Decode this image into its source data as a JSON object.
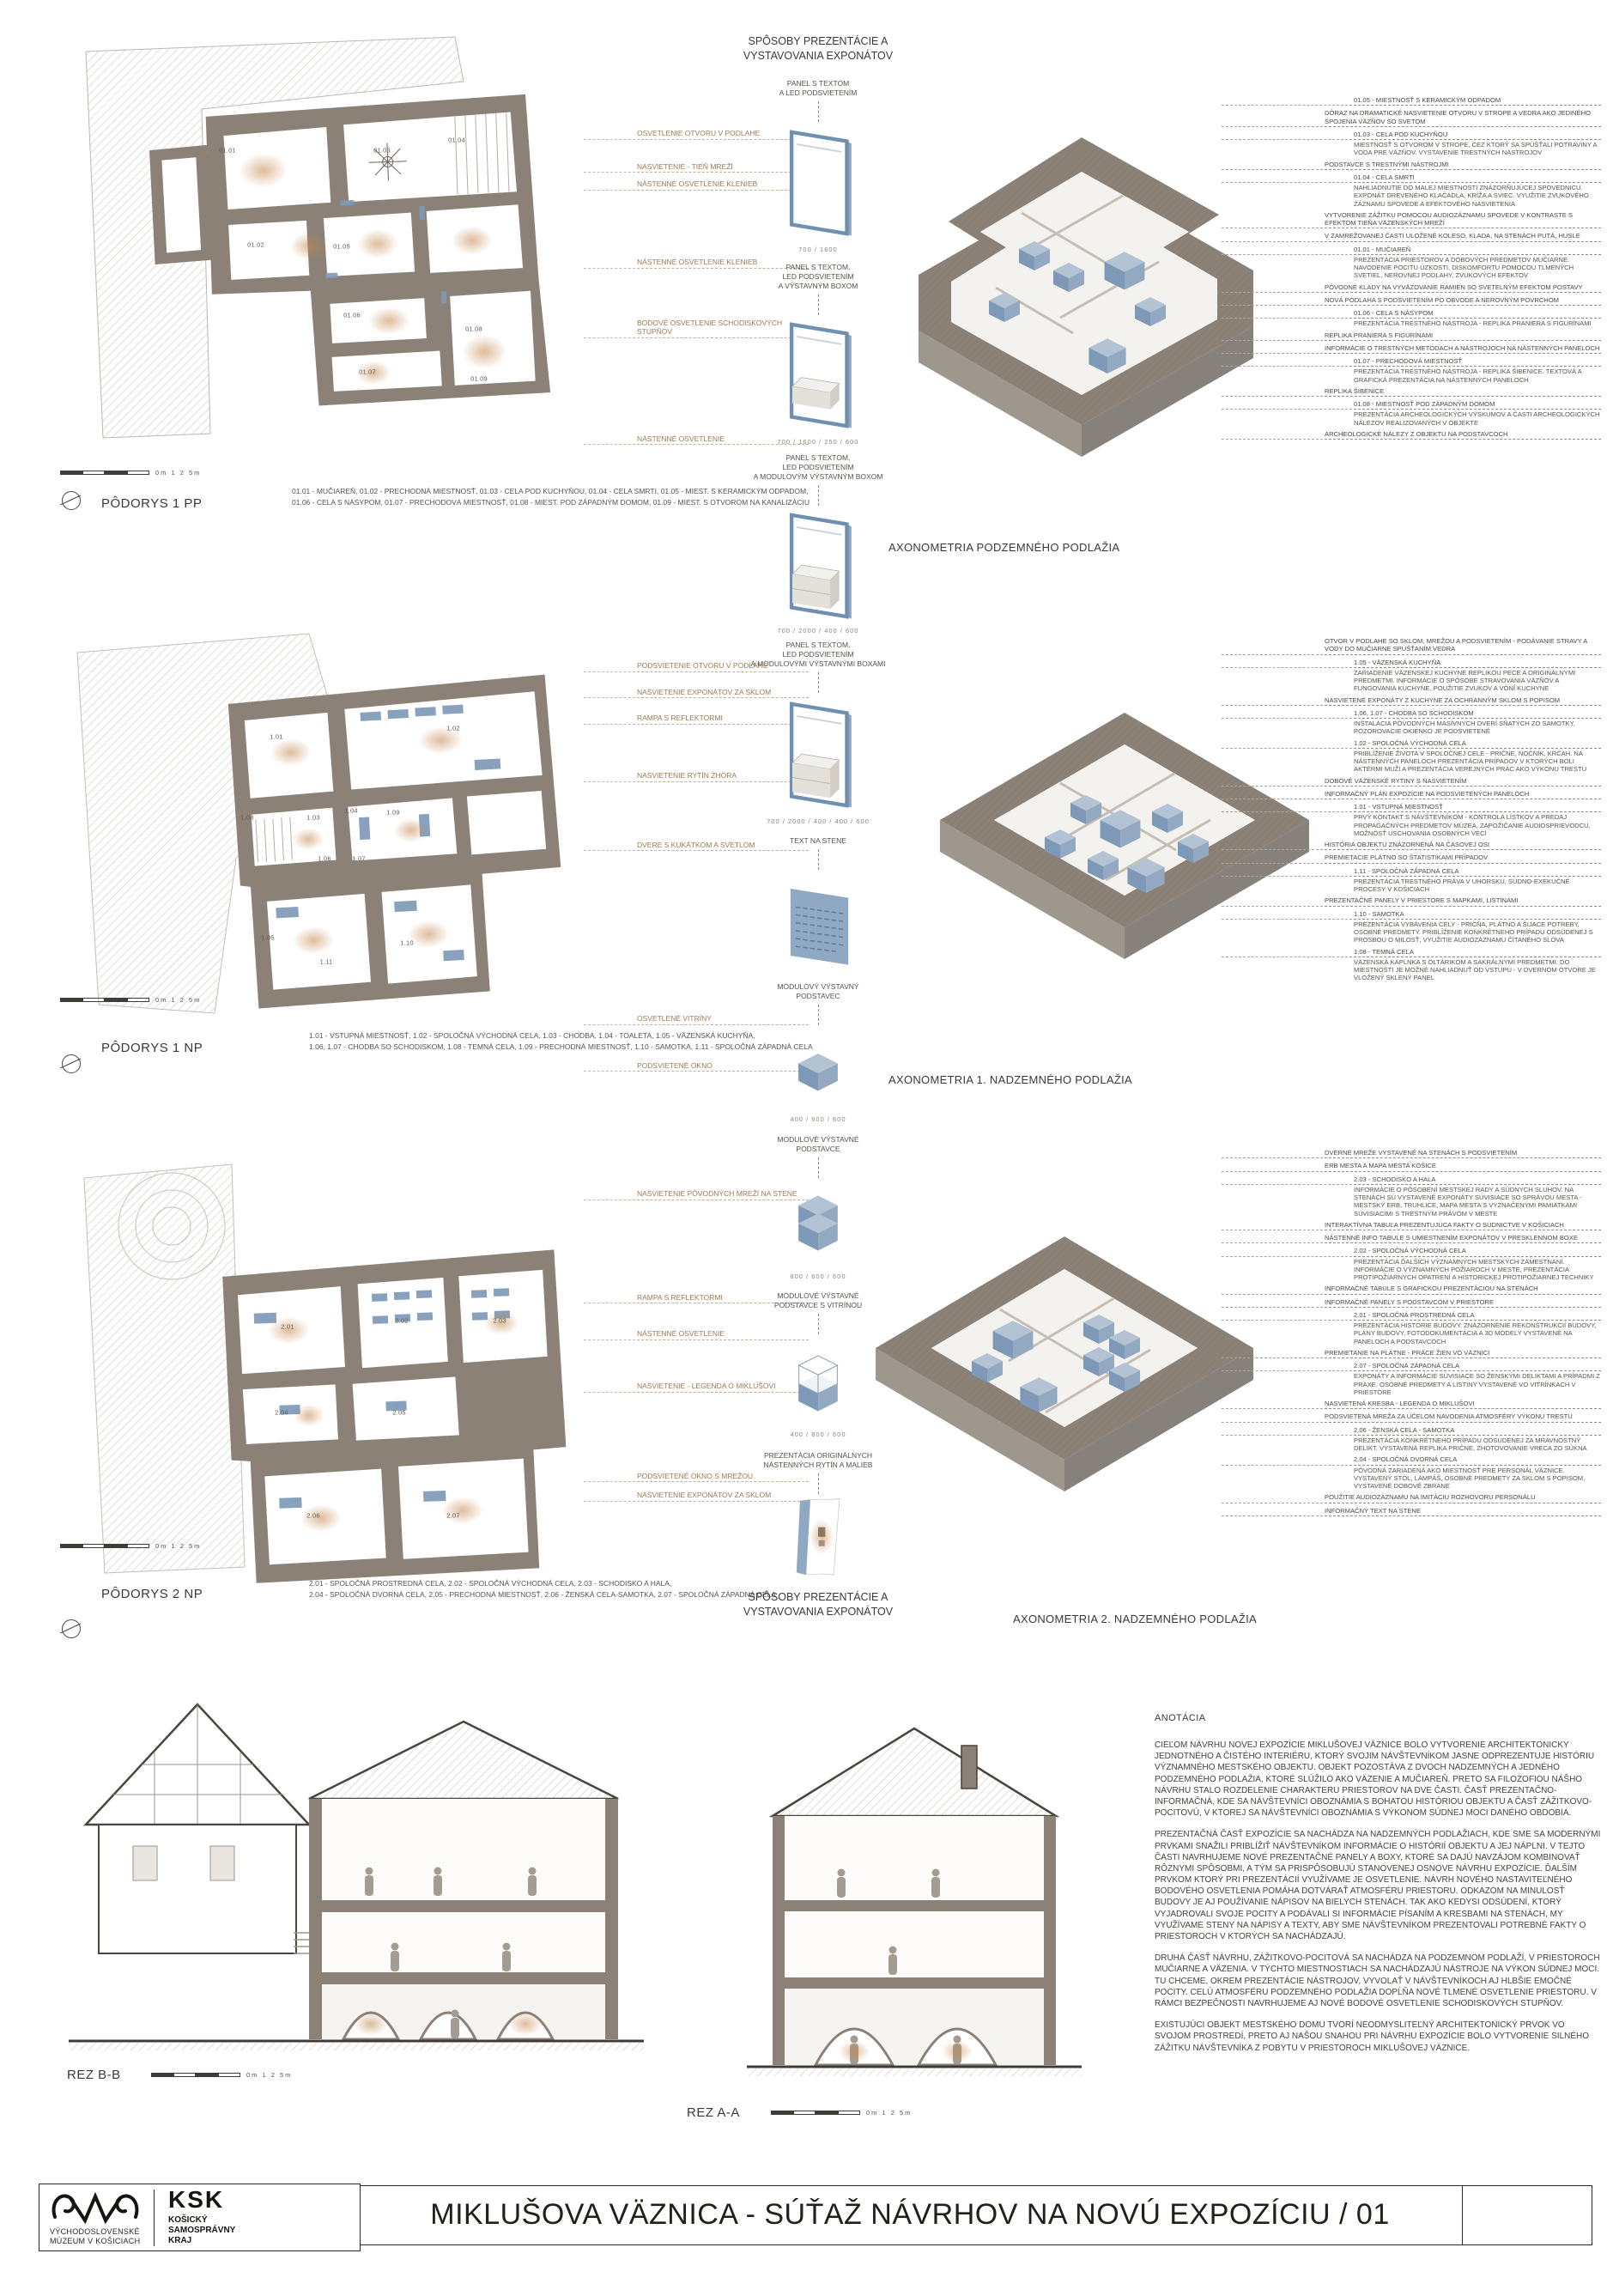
{
  "sheet": {
    "title": "MIKLUŠOVA VÄZNICA - SÚŤAŽ NÁVRHOV NA NOVÚ EXPOZÍCIU / 01"
  },
  "logos": {
    "museum_line1": "VÝCHODOSLOVENSKÉ",
    "museum_line2": "MÚZEUM V KOŠICIACH",
    "ksk_abbr": "KSK",
    "ksk_line1": "KOŠICKÝ",
    "ksk_line2": "SAMOSPRÁVNY",
    "ksk_line3": "KRAJ"
  },
  "methods": {
    "header_top": "SPÔSOBY PREZENTÁCIE A\nVYSTAVOVANIA EXPONÁTOV",
    "header_bottom": "SPÔSOBY PREZENTÁCIE A\nVYSTAVOVANIA EXPONÁTOV",
    "items": [
      {
        "label": "PANEL S TEXTOM\nA LED PODSVIETENÍM",
        "dims": "700 / 1600"
      },
      {
        "label": "PANEL S TEXTOM,\nLED PODSVIETENÍM\nA VÝSTAVNÝM BOXOM",
        "dims": "700 / 1600 / 250 / 600"
      },
      {
        "label": "PANEL S TEXTOM,\nLED PODSVIETENÍM\nA MODULOVÝM VÝSTAVNÝM BOXOM",
        "dims": "700 / 2000 / 400 / 600"
      },
      {
        "label": "PANEL S TEXTOM,\nLED PODSVIETENÍM\nA MODULOVÝMI VÝSTAVNÝMI BOXAMI",
        "dims": "700 / 2000 / 400 / 400 / 600"
      },
      {
        "label": "TEXT NA STENE",
        "dims": ""
      },
      {
        "label": "MODULOVÝ VÝSTAVNÝ\nPODSTAVEC",
        "dims": "400 / 600 / 600"
      },
      {
        "label": "MODULOVÉ VÝSTAVNÉ\nPODSTAVCE",
        "dims": "800 / 600 / 600"
      },
      {
        "label": "MODULOVÉ VÝSTAVNÉ\nPODSTAVCE S VITRÍNOU",
        "dims": "400 / 800 / 600"
      },
      {
        "label": "PREZENTÁCIA ORIGINÁLNYCH\nNÁSTENNÝCH RYTÍN A MALIEB",
        "dims": ""
      }
    ]
  },
  "rows": [
    {
      "plan": {
        "title": "PÔDORYS 1 PP",
        "scale": "0m  1  2  5m",
        "legend": "01.01 - MUČIAREŇ, 01.02 - PRECHODNÁ MIESTNOSŤ, 01.03 - CELA POD KUCHYŇOU, 01.04 - CELA SMRTI, 01.05 - MIEST. S KERAMICKÝM ODPADOM,\n01.06 - CELA S NÁSYPOM, 01.07 - PRECHODOVÁ MIESTNOSŤ, 01.08 - MIEST. POD ZÁPADNÝM DOMOM, 01.09 - MIEST. S OTVOROM NA KANALIZÁCIU",
        "lights": [
          "OSVETLENIE OTVORU V PODLAHE",
          "NASVIETENIE - TIEŇ MREŽÍ",
          "NÁSTENNÉ OSVETLENIE KLENIEB",
          "NÁSTENNÉ OSVETLENIE KLENIEB",
          "BODOVÉ OSVETLENIE SCHODISKOVÝCH STUPŇOV",
          "NÁSTENNÉ OSVETLENIE"
        ],
        "rooms": [
          "01.01",
          "01.02",
          "01.03",
          "01.04",
          "01.05",
          "01.06",
          "01.07",
          "01.08",
          "01.09"
        ]
      },
      "axon": {
        "caption": "AXONOMETRIA PODZEMNÉHO PODLAŽIA"
      },
      "annotations": [
        {
          "t": "r",
          "label": "01.05 - MIESTNOSŤ S KERAMICKÝM ODPADOM",
          "desc": ""
        },
        {
          "t": "c",
          "label": "DÔRAZ NA DRAMATICKÉ NASVIETENIE OTVORU V STROPE A VEDRA AKO JEDINÉHO SPOJENIA VÄZŇOV SO SVETOM",
          "desc": ""
        },
        {
          "t": "r",
          "label": "01.03 - CELA POD KUCHYŇOU",
          "desc": "MIESTNOSŤ S OTVOROM V STROPE, CEZ KTORÝ SA SPÚŠŤALI POTRAVINY A VODA PRE VÄZŇOV. VYSTAVENIE TRESTNÝCH NÁSTROJOV"
        },
        {
          "t": "c",
          "label": "PODSTAVCE S TRESTNÝMI NÁSTROJMI",
          "desc": ""
        },
        {
          "t": "r",
          "label": "01.04 - CELA SMRTI",
          "desc": "NAHLIADNUTIE DO MALEJ MIESTNOSTI ZNÁZORŇUJÚCEJ SPOVEDNICU. EXPONÁT DREVENÉHO KLAČADLA, KRÍŽA A SVIEC. VYUŽITIE ZVUKOVÉHO ZÁZNAMU SPOVEDE A EFEKTOVÉHO NASVIETENIA"
        },
        {
          "t": "c",
          "label": "VYTVORENIE ZÁŽITKU POMOCOU AUDIOZÁZNAMU SPOVEDE V KONTRASTE S EFEKTOM TIEŇA VÄZENSKÝCH MREŽÍ",
          "desc": ""
        },
        {
          "t": "c",
          "label": "V ZAMREŽOVANEJ ČASTI ULOŽENÉ KOLESO, KLADA, NA STENÁCH PUTÁ, HUSLE",
          "desc": ""
        },
        {
          "t": "r",
          "label": "01.01 - MUČIAREŇ",
          "desc": "PREZENTÁCIA PRIESTOROV A DOBOVÝCH PREDMETOV MUČIARNE. NAVODENIE POCITU ÚZKOSTI, DISKOMFORTU POMOCOU TLMENÝCH SVETIEL, NEROVNEJ PODLAHY, ZVUKOVÝCH EFEKTOV"
        },
        {
          "t": "c",
          "label": "PÔVODNÉ KLADY NA VYVÄZOVANIE RAMIEN SO SVETELNÝM EFEKTOM POSTAVY",
          "desc": ""
        },
        {
          "t": "c",
          "label": "NOVÁ PODLAHA S PODSVIETENÍM PO OBVODE A NEROVNÝM POVRCHOM",
          "desc": ""
        },
        {
          "t": "r",
          "label": "01.06 - CELA S NÁSYPOM",
          "desc": "PREZENTÁCIA TRESTNÉHO NÁSTROJA - REPLIKA PRANIERA S FIGURÍNAMI"
        },
        {
          "t": "c",
          "label": "REPLIKA PRANIERA S FIGURÍNAMI",
          "desc": ""
        },
        {
          "t": "c",
          "label": "INFORMÁCIE O TRESTNÝCH METÓDACH A NÁSTROJOCH NA NÁSTENNÝCH PANELOCH",
          "desc": ""
        },
        {
          "t": "r",
          "label": "01.07 - PRECHODOVÁ MIESTNOSŤ",
          "desc": "PREZENTÁCIA TRESTNÉHO NÁSTROJA - REPLIKA ŠIBENICE. TEXTOVÁ A GRAFICKÁ PREZENTÁCIA NA NÁSTENNÝCH PANELOCH"
        },
        {
          "t": "c",
          "label": "REPLIKA ŠIBENICE",
          "desc": ""
        },
        {
          "t": "r",
          "label": "01.08 - MIESTNOSŤ POD ZÁPADNÝM DOMOM",
          "desc": "PREZENTÁCIA ARCHEOLOGICKÝCH VÝSKUMOV A ČASTI ARCHEOLOGICKÝCH NÁLEZOV REALIZOVANÝCH V OBJEKTE"
        },
        {
          "t": "c",
          "label": "ARCHEOLOGICKÉ NÁLEZY Z OBJEKTU NA PODSTAVCOCH",
          "desc": ""
        }
      ]
    },
    {
      "plan": {
        "title": "PÔDORYS 1 NP",
        "scale": "0m  1  2  5m",
        "legend": "1.01 - VSTUPNÁ MIESTNOSŤ, 1.02 - SPOLOČNÁ VÝCHODNÁ CELA, 1.03 - CHODBA, 1.04 - TOALETA, 1.05 - VÄZENSKÁ KUCHYŇA,\n1.06, 1.07 - CHODBA SO SCHODISKOM, 1.08 - TEMNÁ CELA, 1.09 - PRECHODNÁ MIESTNOSŤ, 1.10 - SAMOTKA, 1.11 - SPOLOČNÁ ZÁPADNÁ CELA",
        "lights": [
          "PODSVIETENIE OTVORU V PODLAHE",
          "NASVIETENIE EXPONÁTOV ZA SKLOM",
          "RAMPA S REFLEKTORMI",
          "NASVIETENIE RYTÍN ZHORA",
          "DVERE S KUKÁTKOM A SVETLOM",
          "OSVETLENÉ VITRÍNY",
          "PODSVIETENÉ OKNO"
        ],
        "rooms": [
          "1.01",
          "1.02",
          "1.03",
          "1.04",
          "1.05",
          "1.06",
          "1.07",
          "1.08",
          "1.09",
          "1.10",
          "1.11"
        ]
      },
      "axon": {
        "caption": "AXONOMETRIA 1. NADZEMNÉHO PODLAŽIA"
      },
      "annotations": [
        {
          "t": "c",
          "label": "OTVOR V PODLAHE SO SKLOM, MREŽOU A PODSVIETENÍM - PODÁVANIE STRAVY A VODY DO MUČIARNE SPÚŠŤANÍM VEDRA",
          "desc": ""
        },
        {
          "t": "r",
          "label": "1.05 - VÄZENSKÁ KUCHYŇA",
          "desc": "ZARIADENIE VÄZENSKEJ KUCHYNE REPLIKOU PECE A ORIGINÁLNYMI PREDMETMI. INFORMÁCIE O SPÔSOBE STRAVOVANIA VÄZŇOV A FUNGOVANIA KUCHYNE, POUŽITIE ZVUKOV A VÔNÍ KUCHYNE"
        },
        {
          "t": "c",
          "label": "NASVIETENÉ EXPONÁTY Z KUCHYNE ZA OCHRANNÝM SKLOM S POPISOM",
          "desc": ""
        },
        {
          "t": "r",
          "label": "1.06, 1.07 - CHODBA SO SCHODISKOM",
          "desc": "INŠTALÁCIA PÔVODNÝCH MASÍVNYCH DVERÍ SŇATÝCH ZO SAMOTKY, POZOROVACIE OKIENKO JE PODSVIETENÉ"
        },
        {
          "t": "r",
          "label": "1.02 - SPOLOČNÁ VÝCHODNÁ CELA",
          "desc": "PRIBLÍŽENIE ŽIVOTA V SPOLOČNEJ CELE - PRIČNE, NOČNÍK, KRČAH. NA NÁSTENNÝCH PANELOCH PREZENTÁCIA PRÍPADOV V KTORÝCH BOLI AKTÉRMI MUŽI A PREZENTÁCIA VEREJNÝCH PRÁC AKO VÝKONU TRESTU"
        },
        {
          "t": "c",
          "label": "DOBOVÉ VÄZENSKÉ RYTINY S NASVIETENÍM",
          "desc": ""
        },
        {
          "t": "c",
          "label": "INFORMAČNÝ PLÁN EXPOZÍCIE NA PODSVIETENÝCH PANELOCH",
          "desc": ""
        },
        {
          "t": "r",
          "label": "1.01 - VSTUPNÁ MIESTNOSŤ",
          "desc": "PRVÝ KONTAKT S NÁVŠTEVNÍKOM - KONTROLA LÍSTKOV A PREDAJ PROPAGAČNÝCH PREDMETOV MÚZEA, ZAPOŽIČANIE AUDIOSPRIEVODCU, MOŽNOSŤ USCHOVANIA OSOBNÝCH VECÍ"
        },
        {
          "t": "c",
          "label": "HISTÓRIA OBJEKTU ZNÁZORNENÁ NA ČASOVEJ OSI",
          "desc": ""
        },
        {
          "t": "c",
          "label": "PREMIETACIE PLÁTNO SO ŠTATISTIKAMI PRÍPADOV",
          "desc": ""
        },
        {
          "t": "r",
          "label": "1.11 - SPOLOČNÁ ZÁPADNÁ CELA",
          "desc": "PREZENTÁCIA TRESTNÉHO PRÁVA V UHORSKU, SÚDNO-EXEKUČNÉ PROCESY V KOŠICIACH"
        },
        {
          "t": "c",
          "label": "PREZENTAČNÉ PANELY V PRIESTORE S MAPKAMI, LISTINAMI",
          "desc": ""
        },
        {
          "t": "r",
          "label": "1.10 - SAMOTKA",
          "desc": "PREZENTÁCIA VYBAVENIA CELY - PRIČŇA, PLÁTNO A ŠIJACE POTREBY, OSOBNÉ PREDMETY. PRIBLÍŽENIE KONKRÉTNEHO PRÍPADU ODSÚDENEJ S PROSBOU O MILOSŤ, VYUŽITIE AUDIOZÁZNAMU ČÍTANÉHO SLOVA"
        },
        {
          "t": "r",
          "label": "1.08 - TEMNÁ CELA",
          "desc": "VÄZENSKÁ KAPLNKA S OLTÁRIKOM A SAKRÁLNYMI PREDMETMI. DO MIESTNOSTI JE MOŽNÉ NAHLIADNUŤ OD VSTUPU - V DVERNOM OTVORE JE VLOŽENÝ SKLENÝ PANEL"
        }
      ]
    },
    {
      "plan": {
        "title": "PÔDORYS 2 NP",
        "scale": "0m  1  2  5m",
        "legend": "2.01 - SPOLOČNÁ PROSTREDNÁ CELA, 2.02 - SPOLOČNÁ VÝCHODNÁ CELA, 2.03 - SCHODISKO A HALA,\n2.04 - SPOLOČNÁ DVORNÁ CELA, 2.05 - PRECHODNÁ MIESTNOSŤ, 2.06 - ŽENSKÁ CELA-SAMOTKA, 2.07 - SPOLOČNÁ ZÁPADNÁ CELA",
        "lights": [
          "NASVIETENIE PÔVODNÝCH MREŽÍ NA STENE",
          "RAMPA S REFLEKTORMI",
          "NÁSTENNÉ OSVETLENIE",
          "NASVIETENIE - LEGENDA O MIKLUŠOVI",
          "PODSVIETENÉ OKNO S MREŽOU",
          "NASVIETENIE EXPONÁTOV ZA SKLOM"
        ],
        "rooms": [
          "2.01",
          "2.02",
          "2.03",
          "2.04",
          "2.05",
          "2.06",
          "2.07"
        ]
      },
      "axon": {
        "caption": "AXONOMETRIA 2. NADZEMNÉHO PODLAŽIA"
      },
      "annotations": [
        {
          "t": "c",
          "label": "DVERNÉ MREŽE VYSTAVENÉ NA STENÁCH S PODSVIETENÍM",
          "desc": ""
        },
        {
          "t": "c",
          "label": "ERB MESTA A MAPA MESTA KOŠICE",
          "desc": ""
        },
        {
          "t": "r",
          "label": "2.03 - SCHODISKO A HALA",
          "desc": "INFORMÁCIE O PÔSOBENÍ MESTSKEJ RADY A SÚDNYCH SLUHOV. NA STENÁCH SÚ VYSTAVENÉ EXPONÁTY SÚVISIACE SO SPRÁVOU MESTA - MESTSKÝ ERB, TRUHLICE, MAPA MESTA S VYZNAČENÝMI PAMIATKAMI SÚVISIACIMI S TRESTNÝM PRÁVOM V MESTE"
        },
        {
          "t": "c",
          "label": "INTERAKTÍVNA TABUĽA PREZENTUJÚCA FAKTY O SÚDNICTVE V KOŠICIACH",
          "desc": ""
        },
        {
          "t": "c",
          "label": "NÁSTENNÉ INFO TABULE S UMIESTNENÍM EXPONÁTOV V PRESKLENNOM BOXE",
          "desc": ""
        },
        {
          "t": "r",
          "label": "2.02 - SPOLOČNÁ VÝCHODNÁ CELA",
          "desc": "PREZENTÁCIA ĎALŠÍCH VÝZNAMNÝCH MESTSKÝCH ZAMESTNANÍ. INFORMÁCIE O VÝZNAMNÝCH POŽIAROCH V MESTE, PREZENTÁCIA PROTIPOŽIARNYCH OPATRENÍ A HISTORICKEJ PROTIPOŽIARNEJ TECHNIKY"
        },
        {
          "t": "c",
          "label": "INFORMAČNÉ TABULE S GRAFICKOU PREZENTÁCIOU NA STENÁCH",
          "desc": ""
        },
        {
          "t": "c",
          "label": "INFORMAČNÉ PANELY S PODSTAVCOM V PRIESTORE",
          "desc": ""
        },
        {
          "t": "r",
          "label": "2.01 - SPOLOČNÁ PROSTREDNÁ CELA",
          "desc": "PREZENTÁCIA HISTÓRIE BUDOVY. ZNÁZORNENIE REKONŠTRUKCIÍ BUDOVY, PLÁNY BUDOVY, FOTODOKUMENTÁCIA A 3D MODELY VYSTAVENÉ NA PANELOCH A PODSTAVCOCH"
        },
        {
          "t": "c",
          "label": "PREMIETANIE NA PLÁTNE - PRÁCE ŽIEN VO VÄZNICI",
          "desc": ""
        },
        {
          "t": "r",
          "label": "2.07 - SPOLOČNÁ ZÁPADNÁ CELA",
          "desc": "EXPONÁTY A INFORMÁCIE SÚVISIACE SO ŽENSKÝMI DELIKTAMI A PRÍPADMI Z PRAXE. OSOBNÉ PREDMETY A LISTINY VYSTAVENÉ VO VITRÍNKACH V PRIESTORE"
        },
        {
          "t": "c",
          "label": "NASVIETENÁ KRESBA - LEGENDA O MIKLUŠOVI",
          "desc": ""
        },
        {
          "t": "c",
          "label": "PODSVIETENÁ MREŽA ZA ÚČELOM NAVODENIA ATMOSFÉRY VÝKONU TRESTU",
          "desc": ""
        },
        {
          "t": "r",
          "label": "2.06 - ŽENSKÁ CELA - SAMOTKA",
          "desc": "PREZENTÁCIA KONKRÉTNEHO PRÍPADU ODSÚDENEJ ZA MRAVNOSTNÝ DELIKT. VYSTAVENÁ REPLIKA PRIČNE, ZHOTOVOVANIE VRECA ZO SÚKNA"
        },
        {
          "t": "r",
          "label": "2.04 - SPOLOČNÁ DVORNÁ CELA",
          "desc": "PÔVODNÁ ZARIADENÁ AKO MIESTNOSŤ PRE PERSONÁL VÄZNICE. VYSTAVENÝ STÔL, LAMPÁŠ, OSOBNÉ PREDMETY ZA SKLOM S POPISOM, VYSTAVENÉ DOBOVÉ ZBRANE"
        },
        {
          "t": "c",
          "label": "POUŽITIE AUDIOZÁZNAMU NA IMITÁCIU ROZHOVORU PERSONÁLU",
          "desc": ""
        },
        {
          "t": "c",
          "label": "INFORMAČNÝ TEXT NA STENE",
          "desc": ""
        }
      ]
    }
  ],
  "sections": {
    "left_label": "REZ B-B",
    "right_label": "REZ A-A",
    "scale": "0m  1  2  5m"
  },
  "annotation": {
    "heading": "ANOTÁCIA",
    "paragraphs": [
      "CIEĽOM NÁVRHU NOVEJ EXPOZÍCIE MIKLUŠOVEJ VÄZNICE BOLO VYTVORENIE ARCHITEKTONICKY JEDNOTNÉHO A ČISTÉHO INTERIÉRU, KTORÝ SVOJIM NÁVŠTEVNÍKOM JASNE ODPREZENTUJE HISTÓRIU VÝZNAMNÉHO MESTSKÉHO OBJEKTU. OBJEKT POZOSTÁVA Z DVOCH NADZEMNÝCH A JEDNÉHO PODZEMNÉHO PODLAŽIA, KTORÉ SLÚŽILO AKO VÄZENIE A MUČIAREŇ. PRETO SA FILOZOFIOU NÁŠHO NÁVRHU STALO ROZDELENIE CHARAKTERU PRIESTOROV NA DVE ČASTI. ČASŤ PREZENTAČNO-INFORMAČNÁ, KDE SA NÁVŠTEVNÍCI OBOZNÁMIA S BOHATOU HISTÓRIOU OBJEKTU A ČASŤ ZÁŽITKOVO-POCITOVÚ, V KTOREJ SA NÁVŠTEVNÍCI OBOZNÁMIA S VÝKONOM SÚDNEJ MOCI DANÉHO OBDOBIA.",
      "PREZENTAČNÁ ČASŤ EXPOZÍCIE SA NACHÁDZA NA NADZEMNÝCH PODLAŽIACH, KDE SME SA MODERNÝMI PRVKAMI SNAŽILI PRIBLÍŽIŤ NÁVŠTEVNÍKOM INFORMÁCIE O HISTÓRIÍ OBJEKTU A JEJ NÁPLNI. V TEJTO ČASTI NAVRHUJEME NOVÉ PREZENTAČNÉ PANELY A BOXY, KTORÉ SA DAJÚ NAVZÁJOM KOMBINOVAŤ RÔZNYMI SPÔSOBMI, A TÝM SA PRISPÔSOBUJÚ STANOVENEJ OSNOVE NÁVRHU EXPOZÍCIE. ĎALŠÍM PRVKOM KTORÝ PRI PREZENTÁCIÍ VYUŽÍVAME JE OSVETLENIE. NÁVRH NOVÉHO NASTAVITEĽNÉHO BODOVÉHO OSVETLENIA POMÁHA DOTVÁRAŤ ATMOSFÉRU PRIESTORU. ODKAZOM NA MINULOSŤ BUDOVY JE AJ POUŽÍVANIE NÁPISOV NA BIELYCH STENÁCH. TAK AKO KEDYSI ODSÚDENÍ, KTORÝ VYJADROVALI SVOJE POCITY A PODÁVALI SI INFORMÁCIE PÍSANÍM A KRESBAMI NA STENÁCH, MY VYUŽÍVAME STENY NA NÁPISY A TEXTY, ABY SME NÁVŠTEVNÍKOM PREZENTOVALI POTREBNÉ FAKTY O PRIESTOROCH V KTORÝCH SA NACHÁDZAJÚ.",
      "DRUHÁ ČASŤ NÁVRHU, ZÁŽITKOVO-POCITOVÁ SA NACHÁDZA NA PODZEMNOM PODLAŽÍ, V PRIESTOROCH MUČIARNE A VÄZENIA. V TÝCHTO MIESTNOSTIACH SA NACHÁDZAJÚ NÁSTROJE NA VÝKON SÚDNEJ MOCI. TU CHCEME, OKREM PREZENTÁCIE NÁSTROJOV, VYVOLAŤ V NÁVŠTEVNÍKOCH AJ HLBŠIE EMOČNÉ POCITY. CELÚ ATMOSFÉRU PODZEMNÉHO PODLAŽIA DOPĹŇA NOVÉ TLMENÉ OSVETLENIE PRIESTORU. V RÁMCI BEZPEČNOSTI NAVRHUJEME AJ NOVÉ BODOVÉ OSVETLENIE SCHODISKOVÝCH STUPŇOV.",
      "EXISTUJÚCI OBJEKT MESTSKÉHO DOMU TVORÍ NEODMYSLITEĽNÝ ARCHITEKTONICKÝ PRVOK VO SVOJOM PROSTREDÍ, PRETO AJ NAŠOU SNAHOU PRI NÁVRHU EXPOZÍCIE BOLO VYTVORENIE SILNÉHO ZÁŽITKU NÁVŠTEVNÍKA Z POBYTU V PRIESTOROCH MIKLUŠOVEJ VÄZNICE."
    ]
  }
}
